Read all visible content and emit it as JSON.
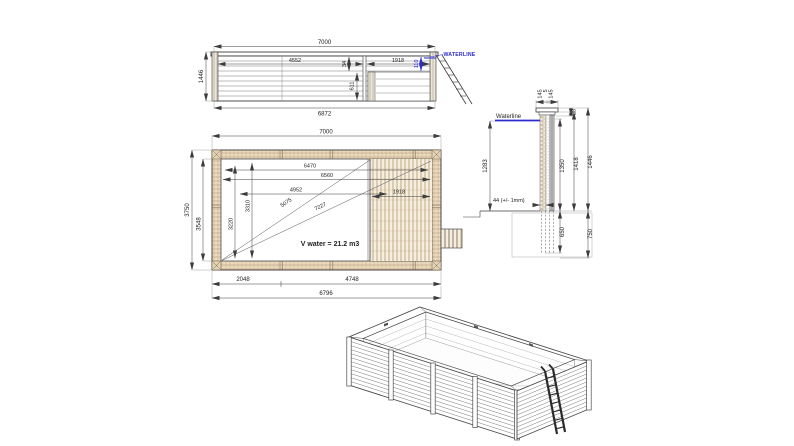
{
  "drawing": {
    "type": "wooden-pool-technical-drawing",
    "colors": {
      "accent_blue": "#2b2bd0",
      "wood_fill": "#eadbbf",
      "wood_line": "#b2906a",
      "ink": "#3c3c3c"
    },
    "elevation": {
      "dim_length_top": "7000",
      "dim_height_left": "1446",
      "dim_length_bottom": "6872",
      "dim_4552": "4552",
      "dim_34": "34",
      "dim_611": "611",
      "dim_1918": "1918",
      "dim_110": "110",
      "waterline_label": "WATERLINE"
    },
    "plan": {
      "dim_length_top": "7000",
      "dim_width_outer": "3750",
      "dim_width_inner": "3548",
      "dim_6470": "6470",
      "dim_6560": "6560",
      "dim_4952": "4952",
      "dim_diag_5075": "5075",
      "dim_diag_7227": "7227",
      "dim_deck_1918": "1918",
      "dim_3310": "3310",
      "dim_3220": "3220",
      "volume_label": "V water = 21.2 m3",
      "dim_2048": "2048",
      "dim_4748": "4748",
      "dim_6796": "6796"
    },
    "section": {
      "cap_dims": [
        "145",
        "5",
        "145"
      ],
      "dim_28": "28",
      "dim_1350": "1350",
      "dim_1418": "1418",
      "dim_1446": "1446",
      "dim_650": "650",
      "dim_750": "750",
      "dim_1283": "1283",
      "waterline_label": "Waterline",
      "tolerance_label": "44 (+/- 1mm)"
    }
  }
}
